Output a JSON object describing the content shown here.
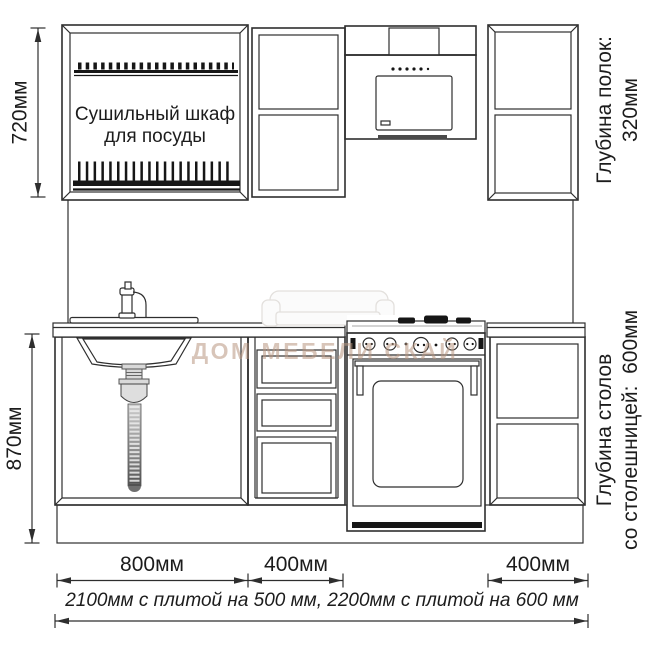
{
  "labels": {
    "drying_line1": "Сушильный шкаф",
    "drying_line2": "для посуды",
    "shelf_depth_line1": "Глубина полок:",
    "shelf_depth_line2": "320мм",
    "counter_depth_line1": "Глубина столов",
    "counter_depth_line2": "со столешницей:  600мм",
    "watermark": "ДОМ МЕБЕЛИ СКАЙ"
  },
  "dimensions": {
    "upper_cabinet_height": "720мм",
    "base_cabinet_height": "870мм",
    "sink_section_width": "800мм",
    "drawer_section_width": "400мм",
    "right_section_width": "400мм",
    "total_width_note": "2100мм с плитой на 500 мм, 2200мм с плитой на 600 мм"
  },
  "colors": {
    "line": "#2e2e2e",
    "dark": "#161616",
    "watermark": "#b99781",
    "background": "#ffffff"
  }
}
